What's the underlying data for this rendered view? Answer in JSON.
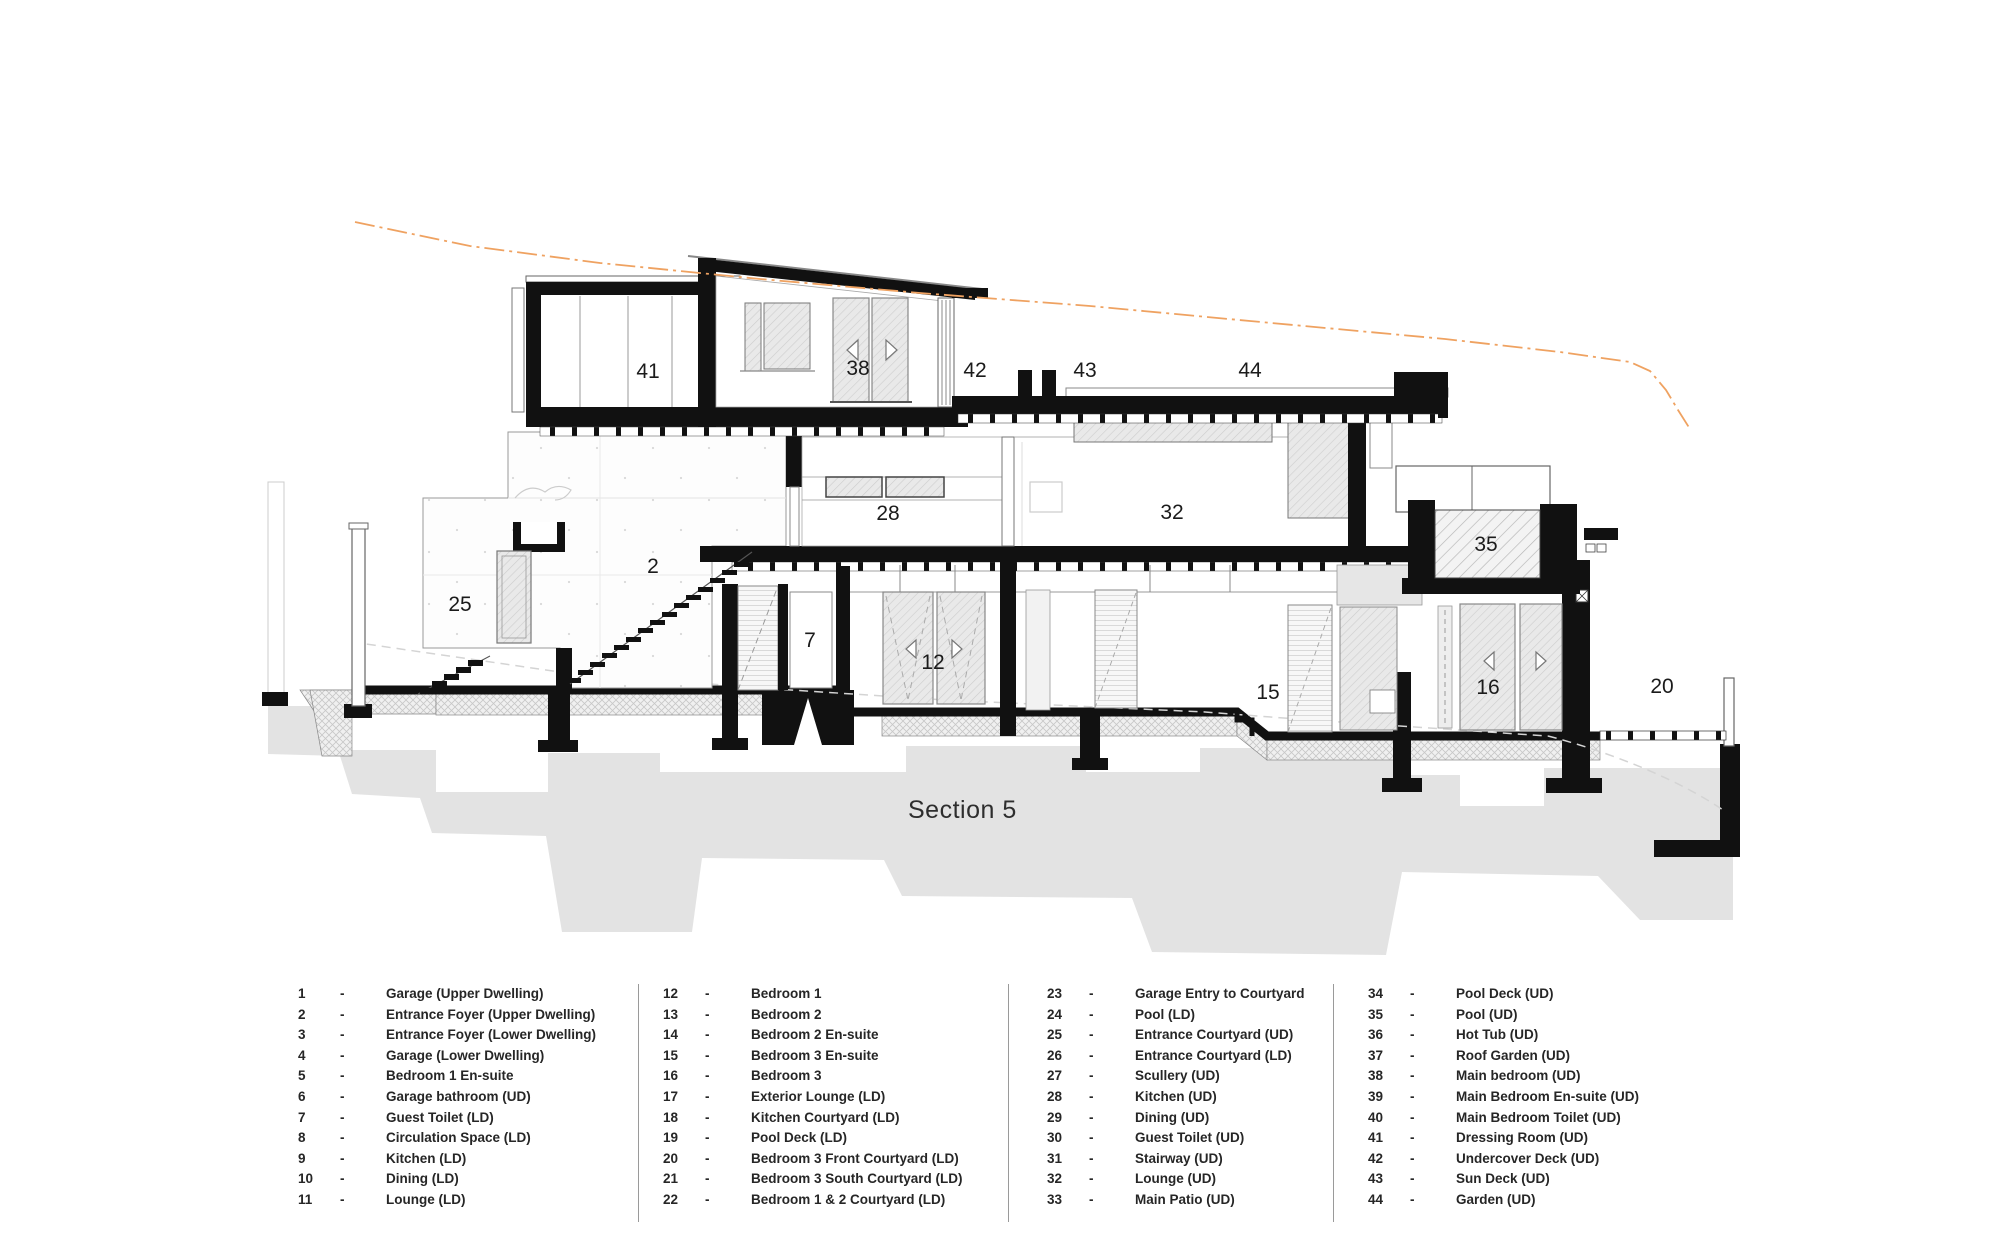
{
  "drawing": {
    "section_title": "Section 5",
    "terrain_color": "#efa261",
    "wall_color": "#111111",
    "shadow_color": "#e3e3e3",
    "labels": {
      "r41": "41",
      "r38": "38",
      "r42": "42",
      "r43": "43",
      "r44": "44",
      "r28": "28",
      "r32": "32",
      "r35": "35",
      "r2": "2",
      "r25": "25",
      "r7": "7",
      "r12": "12",
      "r15": "15",
      "r16": "16",
      "r20": "20"
    }
  },
  "legend": {
    "separator": "-",
    "columns": [
      [
        {
          "num": "1",
          "label": "Garage (Upper Dwelling)"
        },
        {
          "num": "2",
          "label": "Entrance Foyer (Upper Dwelling)"
        },
        {
          "num": "3",
          "label": "Entrance Foyer (Lower Dwelling)"
        },
        {
          "num": "4",
          "label": "Garage (Lower Dwelling)"
        },
        {
          "num": "5",
          "label": "Bedroom 1 En-suite"
        },
        {
          "num": "6",
          "label": "Garage bathroom (UD)"
        },
        {
          "num": "7",
          "label": "Guest Toilet (LD)"
        },
        {
          "num": "8",
          "label": "Circulation Space (LD)"
        },
        {
          "num": "9",
          "label": "Kitchen (LD)"
        },
        {
          "num": "10",
          "label": "Dining (LD)"
        },
        {
          "num": "11",
          "label": "Lounge (LD)"
        }
      ],
      [
        {
          "num": "12",
          "label": "Bedroom 1"
        },
        {
          "num": "13",
          "label": "Bedroom 2"
        },
        {
          "num": "14",
          "label": "Bedroom 2 En-suite"
        },
        {
          "num": "15",
          "label": "Bedroom 3 En-suite"
        },
        {
          "num": "16",
          "label": "Bedroom 3"
        },
        {
          "num": "17",
          "label": "Exterior Lounge (LD)"
        },
        {
          "num": "18",
          "label": "Kitchen Courtyard (LD)"
        },
        {
          "num": "19",
          "label": "Pool Deck (LD)"
        },
        {
          "num": "20",
          "label": "Bedroom 3 Front Courtyard (LD)"
        },
        {
          "num": "21",
          "label": "Bedroom 3 South Courtyard (LD)"
        },
        {
          "num": "22",
          "label": "Bedroom 1 & 2 Courtyard (LD)"
        }
      ],
      [
        {
          "num": "23",
          "label": "Garage Entry to Courtyard"
        },
        {
          "num": "24",
          "label": "Pool (LD)"
        },
        {
          "num": "25",
          "label": "Entrance Courtyard (UD)"
        },
        {
          "num": "26",
          "label": "Entrance Courtyard (LD)"
        },
        {
          "num": "27",
          "label": "Scullery (UD)"
        },
        {
          "num": "28",
          "label": "Kitchen (UD)"
        },
        {
          "num": "29",
          "label": "Dining (UD)"
        },
        {
          "num": "30",
          "label": "Guest Toilet (UD)"
        },
        {
          "num": "31",
          "label": "Stairway (UD)"
        },
        {
          "num": "32",
          "label": "Lounge (UD)"
        },
        {
          "num": "33",
          "label": "Main Patio (UD)"
        }
      ],
      [
        {
          "num": "34",
          "label": "Pool Deck (UD)"
        },
        {
          "num": "35",
          "label": "Pool (UD)"
        },
        {
          "num": "36",
          "label": "Hot Tub (UD)"
        },
        {
          "num": "37",
          "label": "Roof Garden (UD)"
        },
        {
          "num": "38",
          "label": "Main bedroom (UD)"
        },
        {
          "num": "39",
          "label": "Main Bedroom En-suite (UD)"
        },
        {
          "num": "40",
          "label": "Main Bedroom Toilet (UD)"
        },
        {
          "num": "41",
          "label": "Dressing Room (UD)"
        },
        {
          "num": "42",
          "label": "Undercover Deck (UD)"
        },
        {
          "num": "43",
          "label": "Sun Deck (UD)"
        },
        {
          "num": "44",
          "label": "Garden (UD)"
        }
      ]
    ]
  }
}
